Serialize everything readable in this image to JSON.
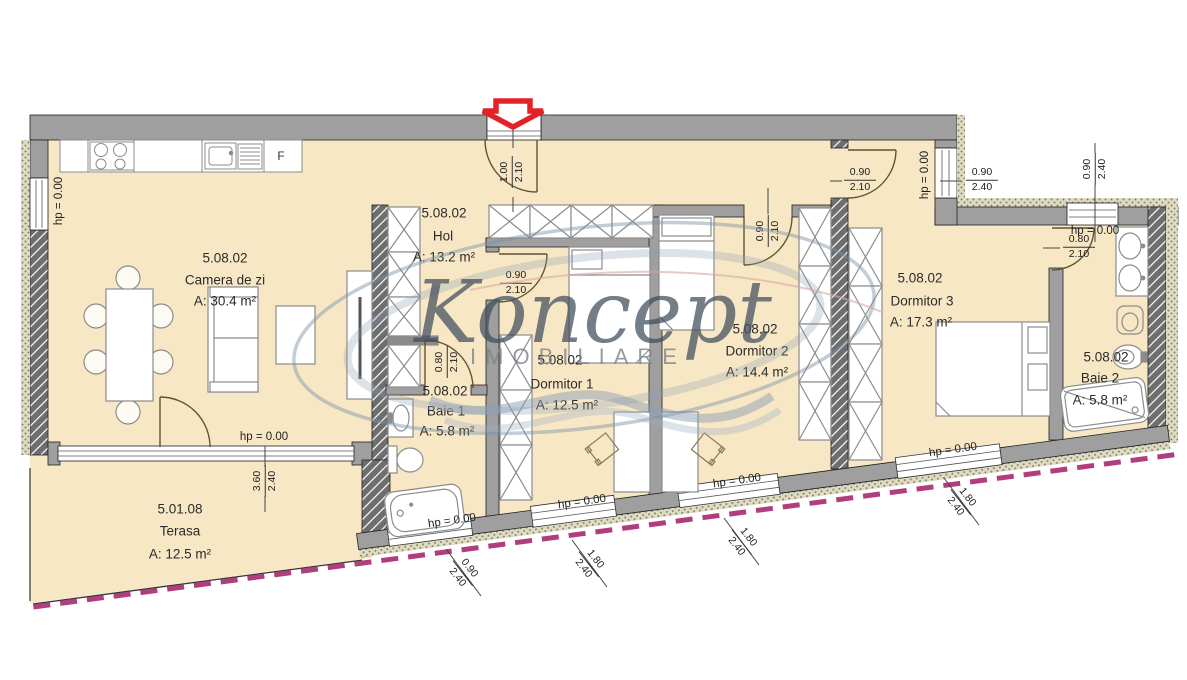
{
  "watermark": {
    "brand": "Koncept",
    "subtitle": "IMOBILIARE"
  },
  "rooms": {
    "camera_de_zi": {
      "code": "5.08.02",
      "name": "Camera de zi",
      "area": "A: 30.4 m²"
    },
    "hol": {
      "code": "5.08.02",
      "name": "Hol",
      "area": "A: 13.2 m²"
    },
    "baie_1": {
      "code": "5.08.02",
      "name": "Baie 1",
      "area": "A: 5.8 m²"
    },
    "dormitor_1": {
      "code": "5.08.02",
      "name": "Dormitor 1",
      "area": "A: 12.5 m²"
    },
    "dormitor_2": {
      "code": "5.08.02",
      "name": "Dormitor 2",
      "area": "A: 14.4 m²"
    },
    "dormitor_3": {
      "code": "5.08.02",
      "name": "Dormitor 3",
      "area": "A: 17.3 m²"
    },
    "baie_2": {
      "code": "5.08.02",
      "name": "Baie 2",
      "area": "A: 5.8 m²"
    },
    "terasa": {
      "code": "5.01.08",
      "name": "Terasa",
      "area": "A: 12.5 m²"
    }
  },
  "levels": {
    "hp": "hp = 0.00"
  },
  "openings": {
    "entrance_door": {
      "w": "1.00",
      "h": "2.10"
    },
    "dormitor_1_door": {
      "w": "0.90",
      "h": "2.10"
    },
    "baie_1_door": {
      "w": "0.80",
      "h": "2.10"
    },
    "dormitor_2_door": {
      "w": "0.90",
      "h": "2.10"
    },
    "dormitor_3_door": {
      "w": "0.90",
      "h": "2.10"
    },
    "baie_2_door": {
      "w": "0.80",
      "h": "2.10"
    },
    "hol_window": {
      "w": "0.90",
      "h": "2.40"
    },
    "baie_2_window": {
      "w": "0.90",
      "h": "2.40"
    },
    "terasa_window": {
      "w": "3.60",
      "h": "2.40"
    },
    "baie_1_window": {
      "w": "0.90",
      "h": "2.40"
    },
    "dormitor_1_window": {
      "w": "1.80",
      "h": "2.40"
    },
    "dormitor_2_window": {
      "w": "1.80",
      "h": "2.40"
    },
    "dormitor_3_window": {
      "w": "1.80",
      "h": "2.40"
    }
  },
  "kitchen": {
    "fridge_label": "F"
  },
  "colors": {
    "floor": "#f8e7c5",
    "wall": "#9f9f9f",
    "hatch_wall": "#6e6e6e",
    "accent_red": "#e32228",
    "property_line": "#b13d7d"
  }
}
